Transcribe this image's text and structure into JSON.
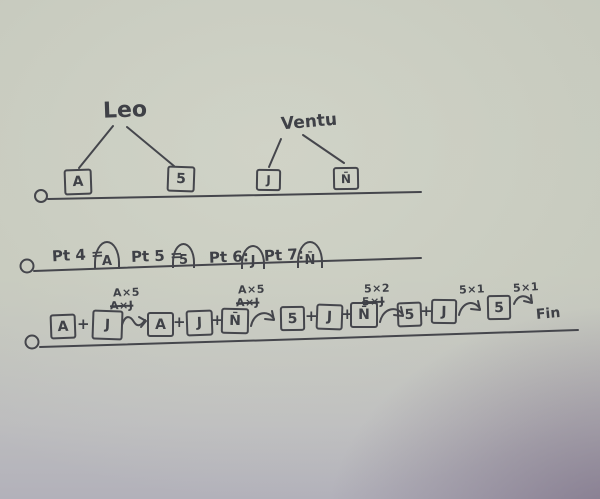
{
  "colors": {
    "paper": "#c5c8bc",
    "ink": "#3f4147",
    "corner_vignette": "#5c4a68"
  },
  "trees": [
    {
      "name": "Leo",
      "left_card": "A",
      "right_card": "5"
    },
    {
      "name": "Ventu",
      "left_card": "J",
      "right_card": "N̄"
    }
  ],
  "points_row": {
    "items": [
      {
        "label": "Pt 4 =",
        "card": "A"
      },
      {
        "label": "Pt 5 =",
        "card": "5"
      },
      {
        "label": "Pt 6:",
        "card": "J"
      },
      {
        "label": "Pt 7:",
        "card": "N̄"
      }
    ]
  },
  "sequence_row": {
    "plus": "+",
    "boxes": [
      "A",
      "J",
      "A",
      "J",
      "N̄",
      "5",
      "J",
      "N̄",
      "5",
      "J",
      "5"
    ],
    "arrows": [
      {
        "label": "A×5",
        "crossed": "A×J"
      },
      {
        "label": "A×5",
        "crossed": "A×J"
      },
      {
        "label": "5×2",
        "crossed": "5×J"
      },
      {
        "label": "5×1"
      },
      {
        "label": "5×1"
      }
    ],
    "end_label": "Fin"
  }
}
